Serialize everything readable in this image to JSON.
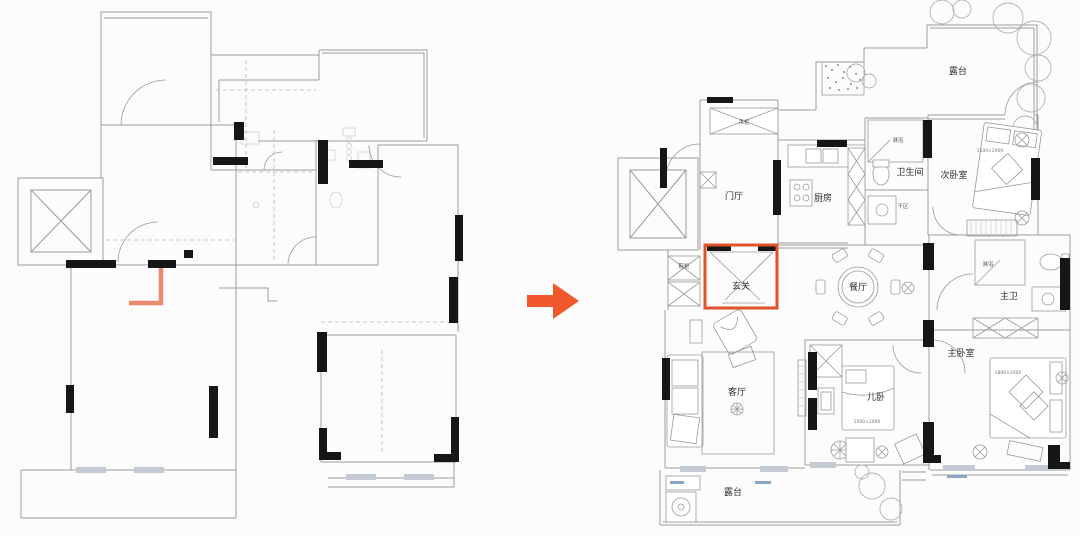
{
  "colors": {
    "accent_orange": "#f1582c",
    "highlight_box": "#e0522a",
    "marker_orange": "#e98a6e",
    "wall_black": "#161616",
    "line_gray": "#9b9b9b",
    "line_light": "#c9c9c9",
    "window_fill": "#c3cad3"
  },
  "transform_arrow": {
    "direction": "right"
  },
  "left_plan": {
    "kind": "original-structure-floor-plan",
    "text_labels": []
  },
  "right_plan": {
    "kind": "furnished-layout-floor-plan",
    "rooms": [
      {
        "id": "terrace-top",
        "label": "露台"
      },
      {
        "id": "entrance-hall",
        "label": "门厅"
      },
      {
        "id": "kitchen",
        "label": "厨房"
      },
      {
        "id": "bathroom",
        "label": "卫生间"
      },
      {
        "id": "second-bedroom",
        "label": "次卧室"
      },
      {
        "id": "foyer",
        "label": "玄关",
        "highlighted": true
      },
      {
        "id": "dining-room",
        "label": "餐厅"
      },
      {
        "id": "master-bath",
        "label": "主卫"
      },
      {
        "id": "living-room",
        "label": "客厅"
      },
      {
        "id": "kids-bedroom",
        "label": "儿卧"
      },
      {
        "id": "master-bedroom",
        "label": "主卧室"
      },
      {
        "id": "terrace-bottom",
        "label": "露台"
      }
    ],
    "small_labels": [
      {
        "id": "hanging-cabinet",
        "label": "吊柜"
      },
      {
        "id": "shoe-cabinet",
        "label": "鞋柜"
      },
      {
        "id": "shower-bathroom",
        "label": "淋浴"
      },
      {
        "id": "dry-area",
        "label": "干区"
      },
      {
        "id": "shower-master-bath",
        "label": "淋浴"
      }
    ],
    "dimensions": [
      {
        "id": "second-bedroom-bed",
        "label": "1500×2000"
      },
      {
        "id": "kids-bedroom-bed",
        "label": "1500×2000"
      },
      {
        "id": "master-bedroom-bed",
        "label": "1800×2000"
      }
    ]
  }
}
